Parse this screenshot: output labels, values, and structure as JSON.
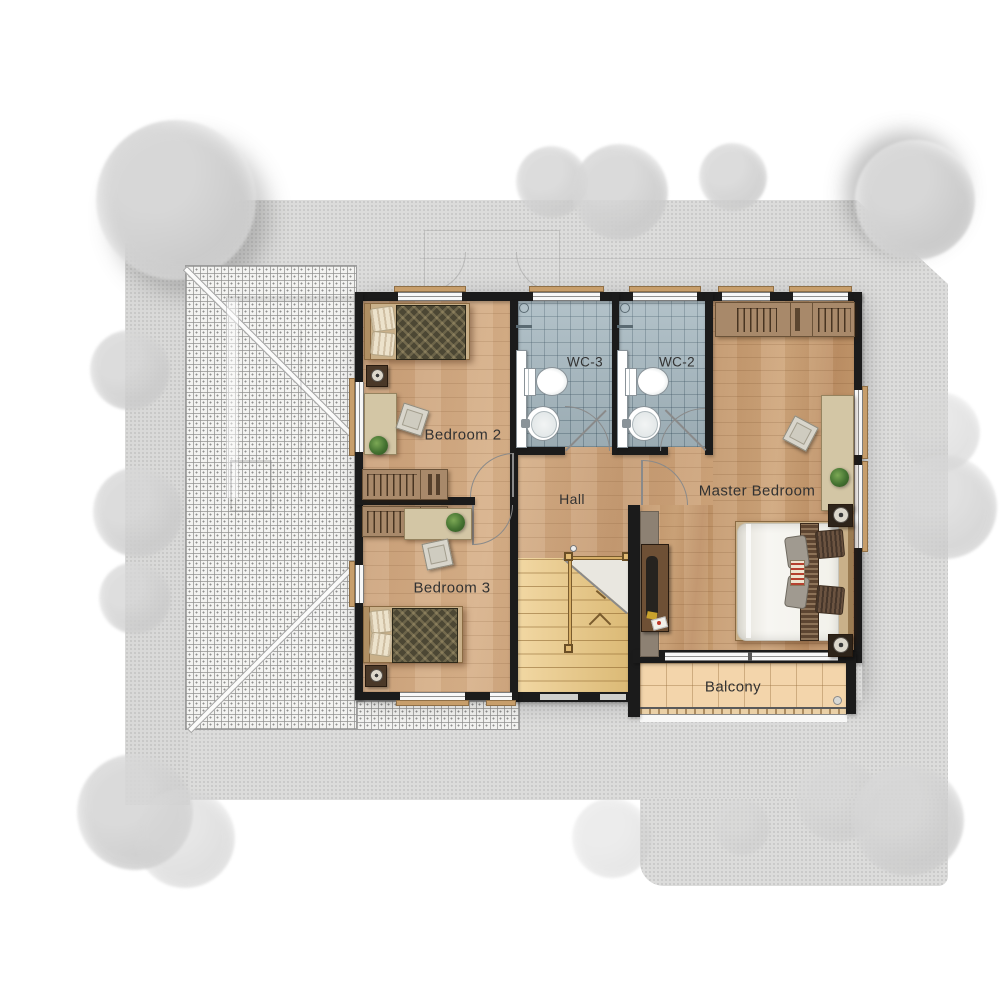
{
  "diagram": {
    "type": "residential floor plan (upper storey, top view)",
    "rooms": {
      "bedroom2": "Bedroom 2",
      "wc3": "WC-3",
      "wc2": "WC-2",
      "master_bedroom": "Master Bedroom",
      "hall": "Hall",
      "bedroom3": "Bedroom 3",
      "balcony": "Balcony"
    },
    "furniture": {
      "bedroom2": [
        "single-bed",
        "nightstand-lamp",
        "desk",
        "chair",
        "plant",
        "wardrobe"
      ],
      "bedroom3": [
        "single-bed",
        "nightstand-lamp",
        "desk",
        "chair",
        "plant",
        "wardrobe"
      ],
      "master_bedroom": [
        "double-bed",
        "nightstand-lamp",
        "nightstand-lamp",
        "wardrobe",
        "desk",
        "chair",
        "plant",
        "tv-cabinet"
      ],
      "wc3": [
        "toilet",
        "sink",
        "shower-screen"
      ],
      "wc2": [
        "toilet",
        "sink",
        "shower-screen"
      ],
      "circulation": [
        "staircase",
        "handrail",
        "door-swings"
      ]
    },
    "site": {
      "tree_count": 16,
      "roof_hatch_below": true
    },
    "colors": {
      "wall": "#1b1b1b",
      "bedroom_floor": "#cda57e",
      "master_floor": "#c69c73",
      "stairs": "#ecc87f",
      "wc_tile": "#a6b8c0",
      "balcony_tile": "#f3d5ab",
      "wardrobe": "#a8896a",
      "site_ground": "#dcdcdb",
      "trees": "#cfcfcf",
      "label_text": "#323232"
    }
  }
}
